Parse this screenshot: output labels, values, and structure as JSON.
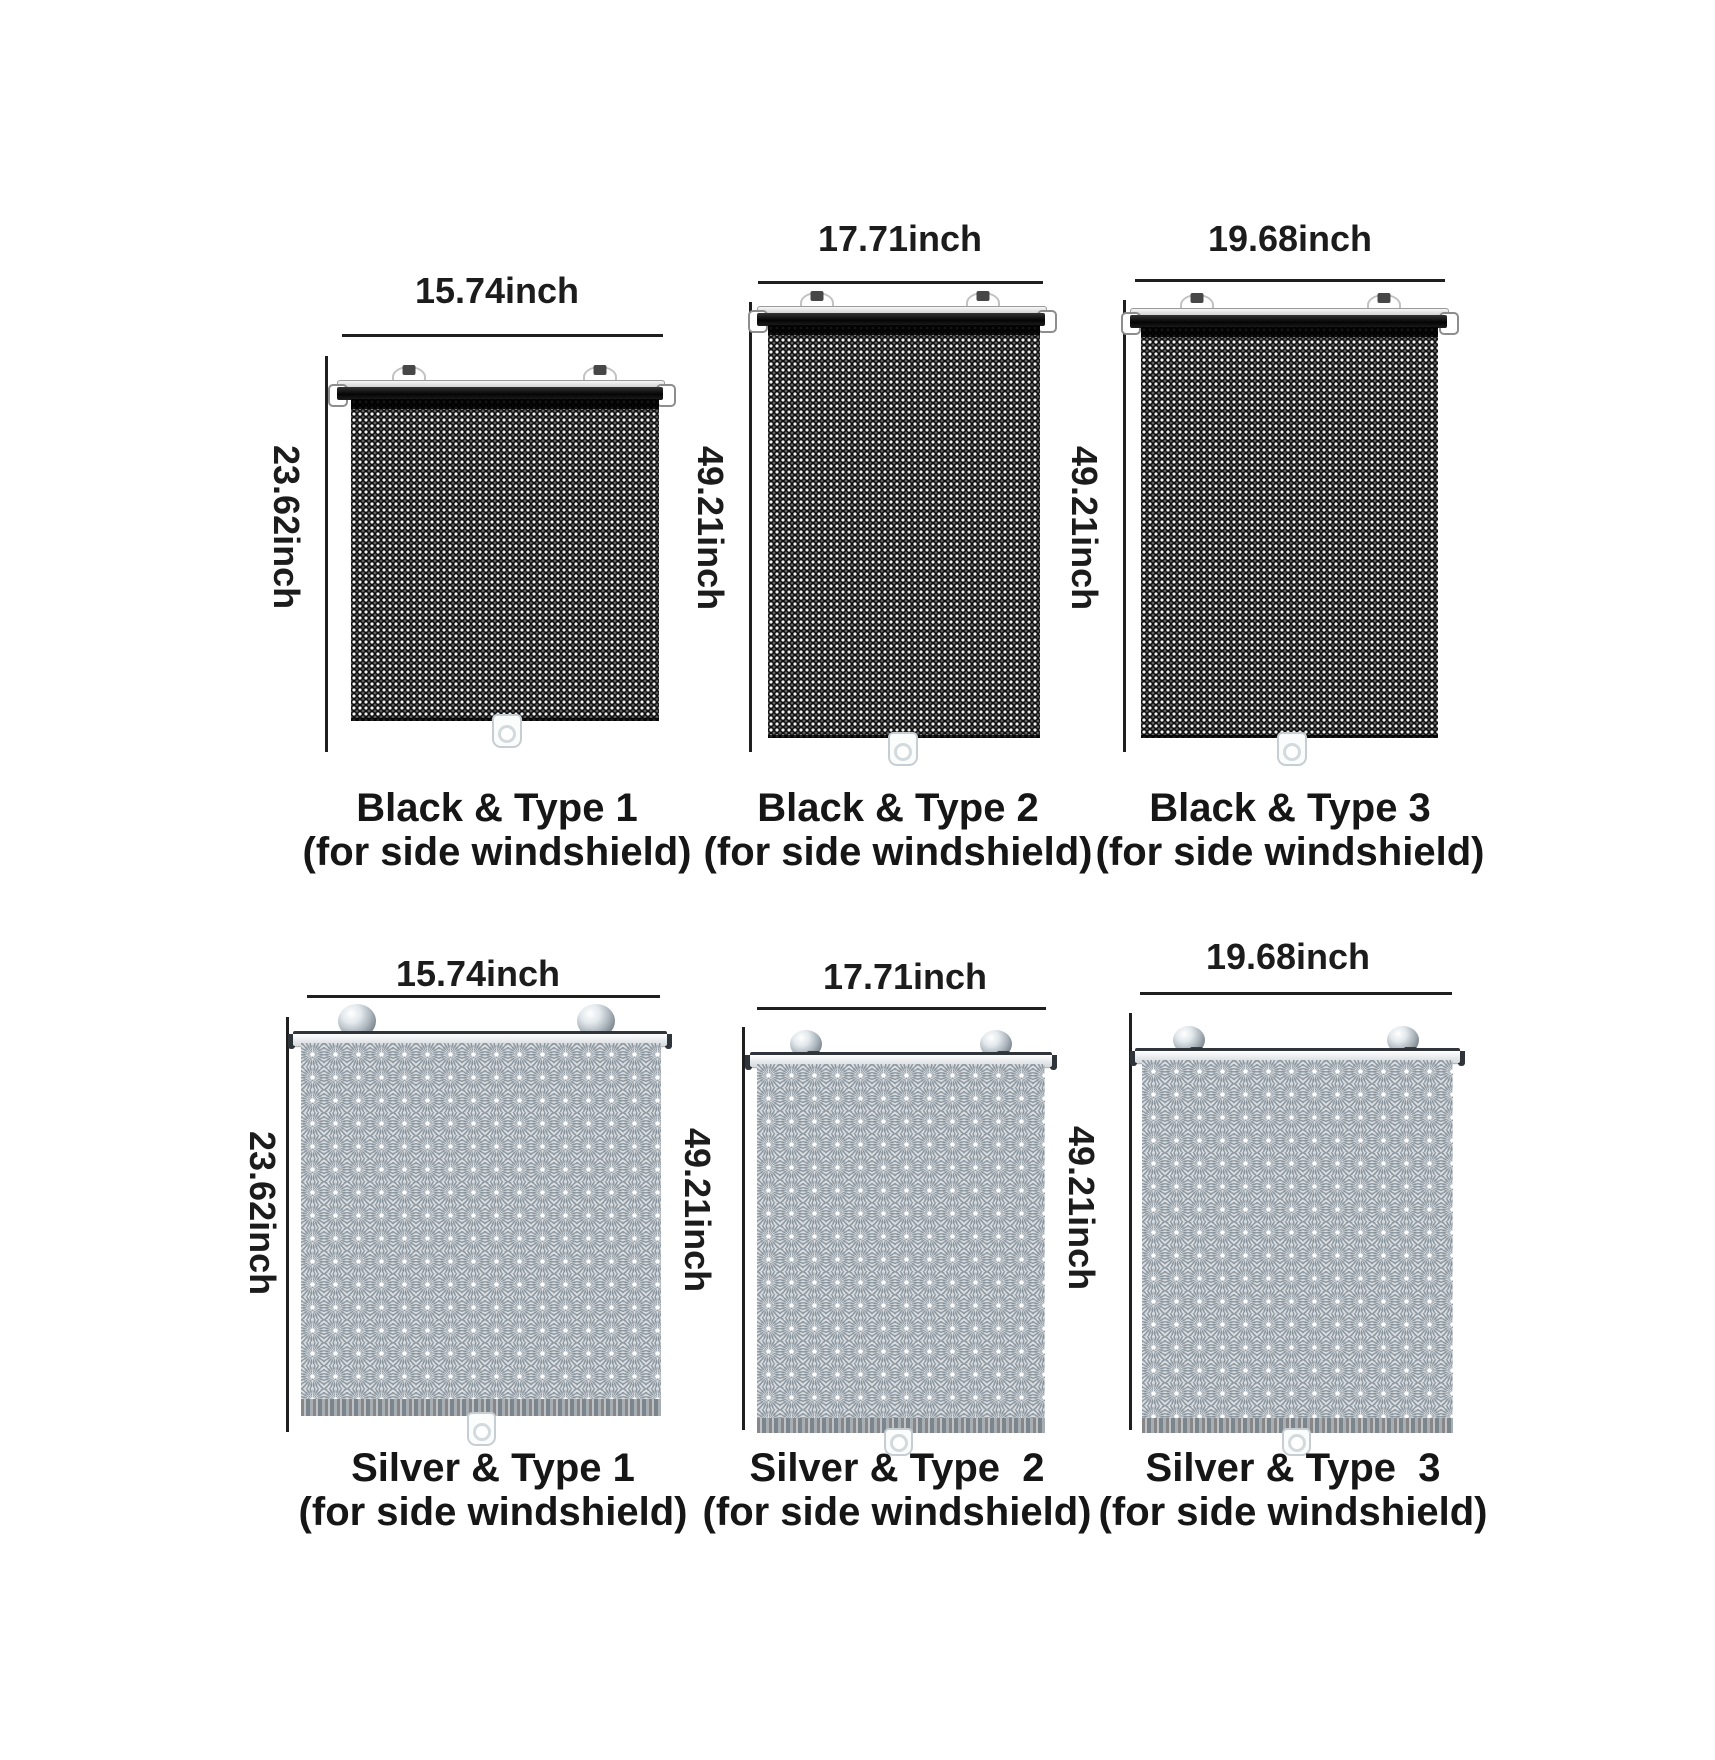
{
  "page": {
    "background": "#ffffff"
  },
  "colors": {
    "text": "#1c1c1c",
    "dimension_line": "#1f1f1f",
    "black_mesh": "#0e0e0e",
    "silver_mesh": "#b0b9c0"
  },
  "panels": [
    {
      "color_name": "black",
      "type": "1",
      "width_label": "15.74inch",
      "height_label": "23.62inch",
      "title": "Black & Type 1",
      "subtitle": "(for side windshield)"
    },
    {
      "color_name": "black",
      "type": "2",
      "width_label": "17.71inch",
      "height_label": "49.21inch",
      "title": "Black & Type 2",
      "subtitle": "(for side windshield)"
    },
    {
      "color_name": "black",
      "type": "3",
      "width_label": "19.68inch",
      "height_label": "49.21inch",
      "title": "Black & Type 3",
      "subtitle": "(for side windshield)"
    },
    {
      "color_name": "silver",
      "type": "1",
      "width_label": "15.74inch",
      "height_label": "23.62inch",
      "title": "Silver & Type 1",
      "subtitle": "(for side windshield)"
    },
    {
      "color_name": "silver",
      "type": "2",
      "width_label": "17.71inch",
      "height_label": "49.21inch",
      "title": "Silver & Type  2",
      "subtitle": "(for side windshield)"
    },
    {
      "color_name": "silver",
      "type": "3",
      "width_label": "19.68inch",
      "height_label": "49.21inch",
      "title": "Silver & Type  3",
      "subtitle": "(for side windshield)"
    }
  ]
}
